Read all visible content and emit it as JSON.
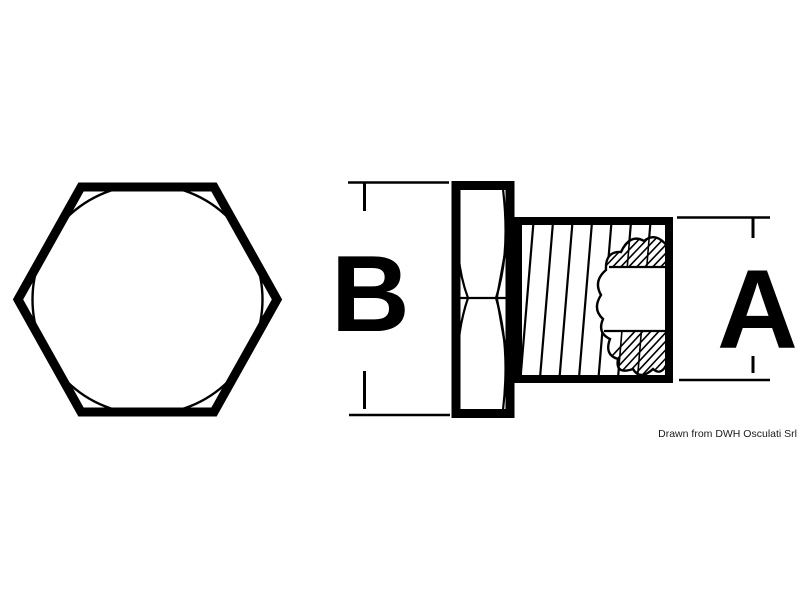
{
  "drawing": {
    "labels": {
      "height_dim": "B",
      "diameter_dim": "A"
    },
    "caption": "Drawn from DWH Osculati Srl",
    "colors": {
      "line": "#000000",
      "background": "#ffffff",
      "caption_text": "#1a1a1a"
    }
  }
}
